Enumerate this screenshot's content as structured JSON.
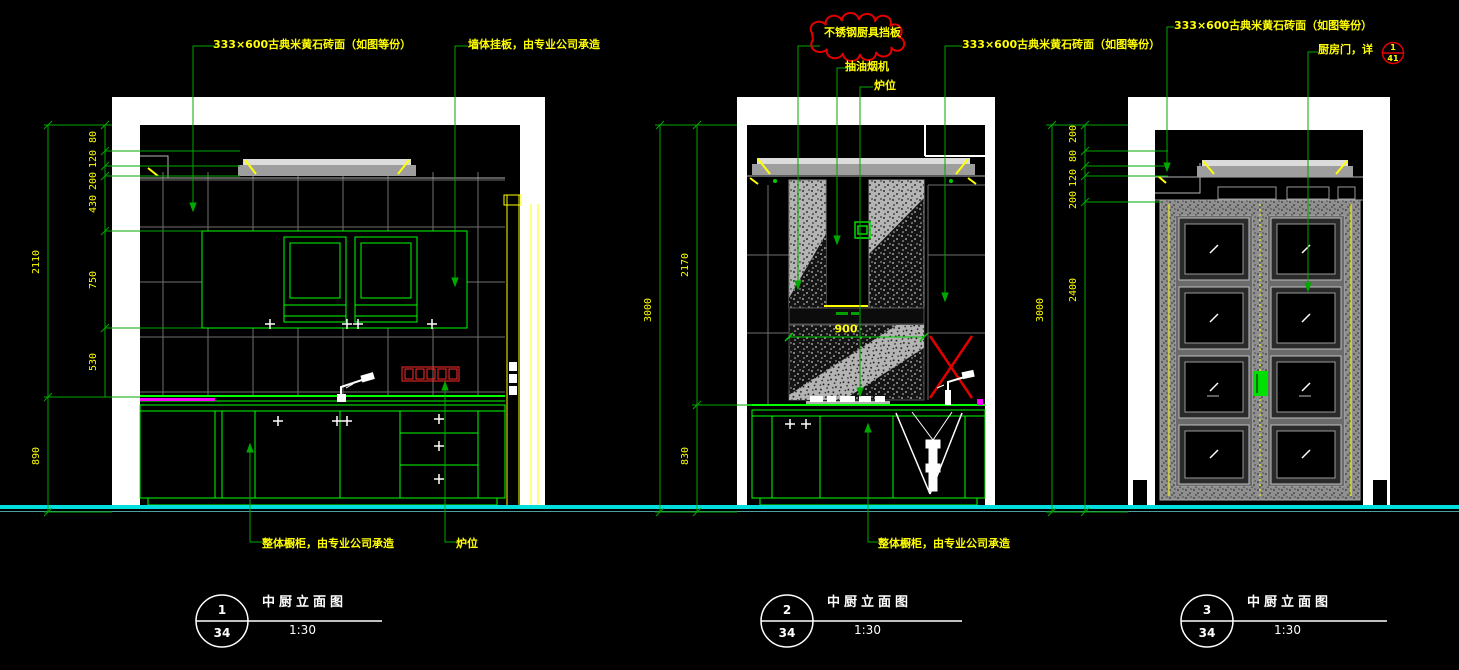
{
  "annotations": {
    "el1": {
      "tile_finish": "333×600古典米黄石砖面（如图等份）",
      "wall_panel": "墙体挂板，由专业公司承造",
      "cabinet": "整体橱柜，由专业公司承造",
      "stove": "炉位"
    },
    "el2": {
      "cloud": "不锈钢厨具挡板",
      "hood": "抽油烟机",
      "stove": "炉位",
      "tile_finish": "333×600古典米黄石砖面（如图等份）",
      "cabinet": "整体橱柜，由专业公司承造",
      "hood_width": "900"
    },
    "el3": {
      "tile_finish": "333×600古典米黄石砖面（如图等份）",
      "door": "厨房门，详",
      "detail_num": "1",
      "detail_sheet": "41"
    }
  },
  "dimensions": {
    "el1": {
      "total_upper": "2110",
      "base": "890",
      "stack": [
        "80",
        "120",
        "200"
      ],
      "chain": [
        "430",
        "750",
        "530"
      ]
    },
    "el2": {
      "total": "3000",
      "upper": "2170",
      "lower": "830"
    },
    "el3": {
      "total": "3000",
      "stack": [
        "200",
        "80",
        "120",
        "200"
      ],
      "door_height": "2400"
    }
  },
  "view_titles": [
    {
      "num": "1",
      "sheet": "34",
      "name": "中厨立面图",
      "scale": "1:30"
    },
    {
      "num": "2",
      "sheet": "34",
      "name": "中厨立面图",
      "scale": "1:30"
    },
    {
      "num": "3",
      "sheet": "34",
      "name": "中厨立面图",
      "scale": "1:30"
    }
  ],
  "colors": {
    "cabinet_green": "#00ff00",
    "dim_green": "#00a800",
    "annotation_yellow": "#ffff00",
    "revision_red": "#e00000",
    "floor_cyan": "#00dede",
    "counter_magenta": "#ff00ff",
    "tile_gray": "#6f6f6f"
  }
}
